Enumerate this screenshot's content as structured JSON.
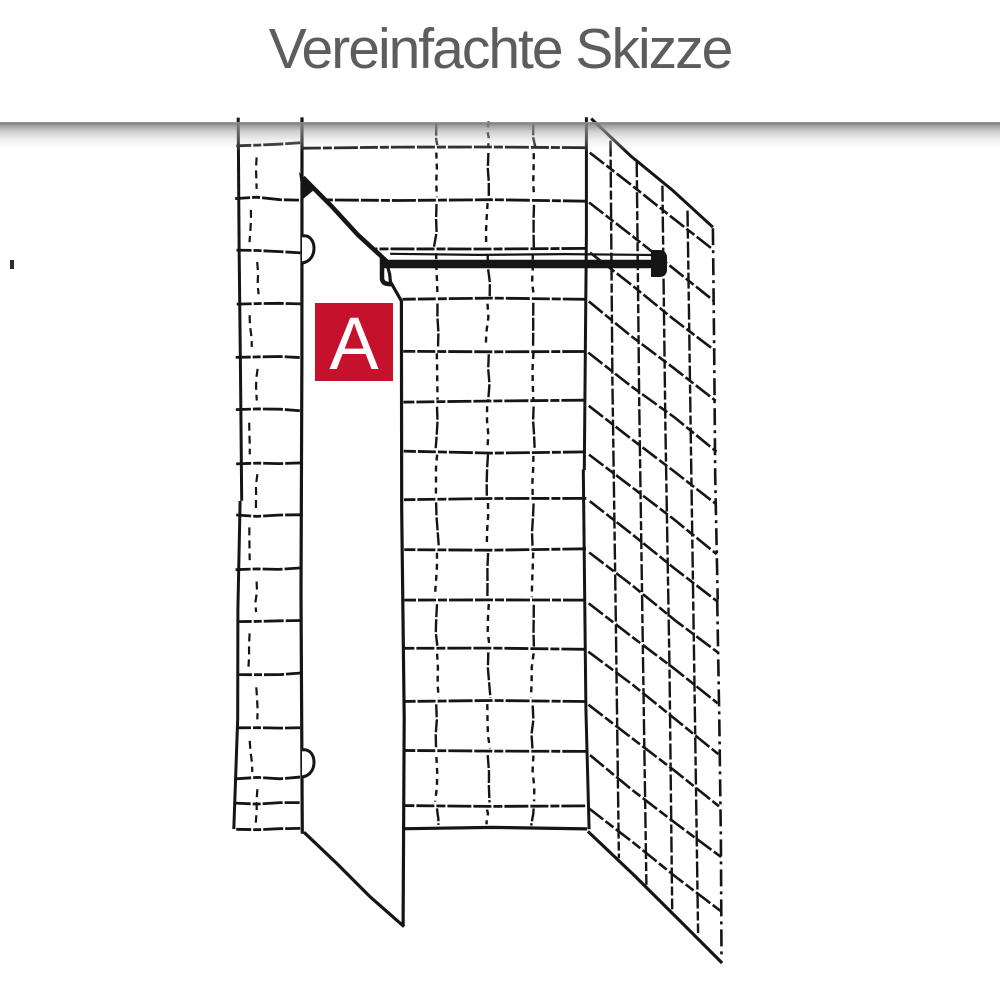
{
  "title": "Vereinfachte Skizze",
  "sketch": {
    "panel_label": "A"
  },
  "colors": {
    "accent_red": "#c5112c",
    "title_gray": "#5d5d5d",
    "line_black": "#151515",
    "label_text_white": "#ffffff",
    "shadow_gray": "#8e8e8e",
    "background": "#ffffff"
  }
}
